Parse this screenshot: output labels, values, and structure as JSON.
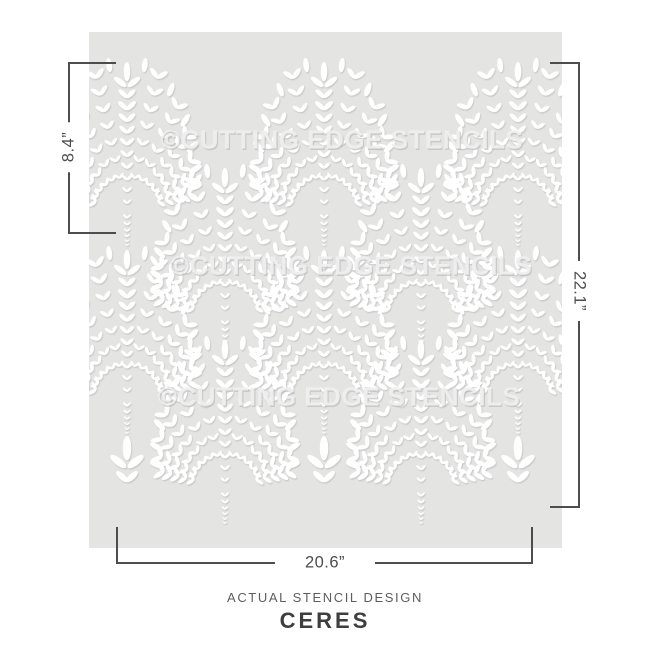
{
  "stencil": {
    "background_color": "#e4e4e3",
    "watermark_text": "©CUTTING EDGE STENCILS",
    "watermark_rows": [
      {
        "x": 342,
        "y": 140
      },
      {
        "x": 351,
        "y": 266
      },
      {
        "x": 339,
        "y": 397
      }
    ],
    "rect": {
      "x": 89,
      "y": 32,
      "width": 473,
      "height": 516
    }
  },
  "pattern": {
    "leaf_color": "#ffffff",
    "shadow_color": "#a8a8a8",
    "fan_positions": [
      [
        127,
        62
      ],
      [
        324,
        62
      ],
      [
        518,
        62
      ],
      [
        225,
        168
      ],
      [
        421,
        168
      ],
      [
        127,
        250
      ],
      [
        324,
        250
      ],
      [
        518,
        250
      ],
      [
        225,
        340
      ],
      [
        421,
        340
      ]
    ],
    "bud_positions": [
      [
        127,
        436
      ],
      [
        324,
        436
      ],
      [
        518,
        436
      ]
    ]
  },
  "dimension_labels": {
    "left": "8.4”",
    "right": "22.1”",
    "bottom": "20.6”"
  },
  "caption": {
    "subtitle": "ACTUAL STENCIL DESIGN",
    "title": "CERES"
  },
  "colors": {
    "dimension_line": "#4d4d4d",
    "caption_subtitle": "#5e5e5e",
    "caption_title": "#3e3e3e"
  }
}
